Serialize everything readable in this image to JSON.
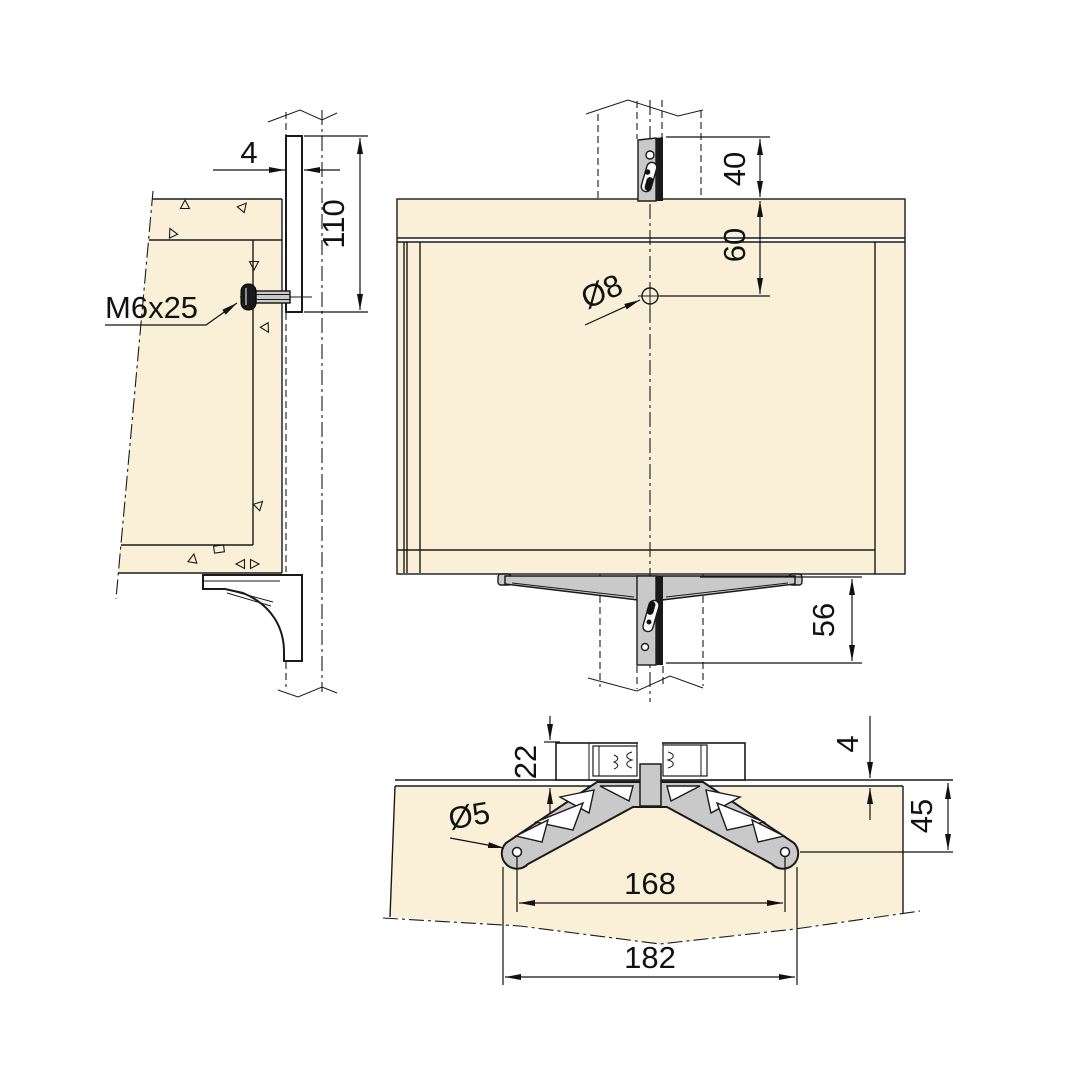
{
  "drawing": {
    "type": "furniture-bracket-installation-technical-drawing",
    "units": "mm"
  },
  "colors": {
    "wood": "#FAF0D8",
    "metal": "#C9C9C9",
    "line": "#1A1A1A",
    "bg": "#FFFFFF"
  },
  "views": {
    "side": {
      "label": "side-section-view",
      "dims": {
        "plate_thickness": "4",
        "plate_height": "110",
        "screw": "M6x25"
      }
    },
    "front": {
      "label": "front-view",
      "dims": {
        "top_gap": "40",
        "hole_from_top": "60",
        "hole_diameter": "Ø8",
        "bottom_drop": "56"
      }
    },
    "plan": {
      "label": "plan-view",
      "dims": {
        "profile_height": "22",
        "plate_gap": "4",
        "edge_to_hole": "45",
        "hole_diameter": "Ø5",
        "hole_spacing": "168",
        "overall_width": "182"
      }
    }
  }
}
